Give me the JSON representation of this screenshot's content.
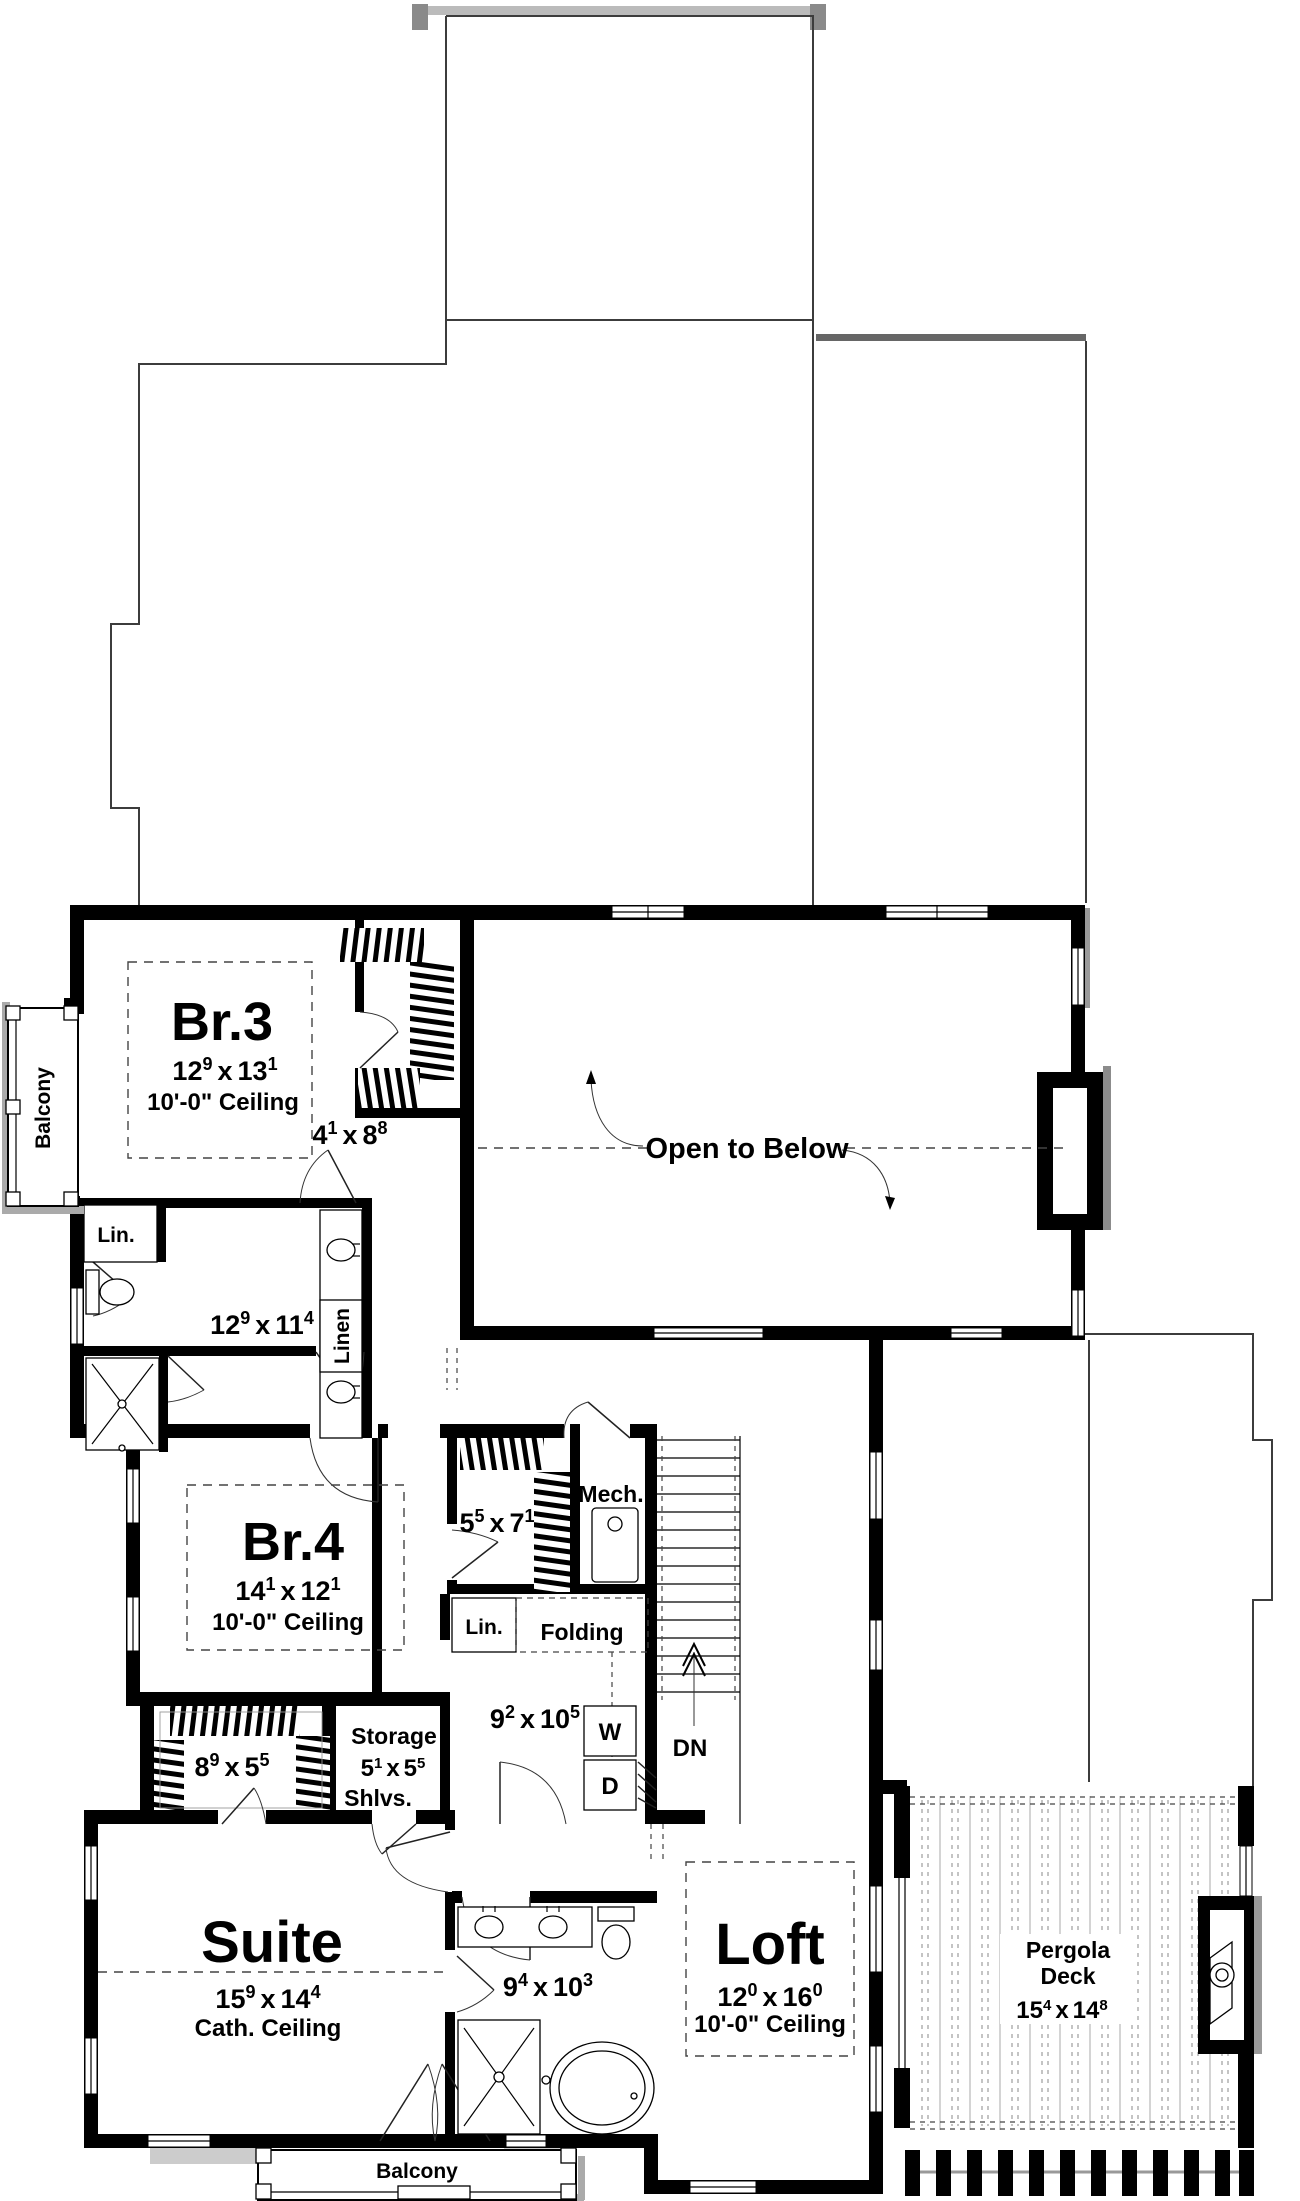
{
  "tokens": {
    "sep": "x"
  },
  "labels": {
    "open_to_below": "Open to Below",
    "balcony_left": "Balcony",
    "balcony_bottom": "Balcony",
    "down": "DN",
    "mech": "Mech.",
    "lin_bath": "Lin.",
    "linen": "Linen",
    "lin_laundry": "Lin.",
    "folding": "Folding",
    "washer": "W",
    "dryer": "D",
    "storage": "Storage",
    "shelves": "Shlvs."
  },
  "rooms": {
    "br3": {
      "name": "Br.3",
      "ceiling": "10'-0\" Ceiling",
      "dim": {
        "w": "12",
        "ws": "9",
        "l": "13",
        "ls": "1"
      }
    },
    "br3_closet": {
      "dim": {
        "w": "4",
        "ws": "1",
        "l": "8",
        "ls": "8"
      }
    },
    "jack_jill_bath": {
      "dim": {
        "w": "12",
        "ws": "9",
        "l": "11",
        "ls": "4"
      }
    },
    "br4": {
      "name": "Br.4",
      "ceiling": "10'-0\" Ceiling",
      "dim": {
        "w": "14",
        "ws": "1",
        "l": "12",
        "ls": "1"
      }
    },
    "br4_closet": {
      "dim": {
        "w": "5",
        "ws": "5",
        "l": "7",
        "ls": "1"
      }
    },
    "laundry": {
      "dim": {
        "w": "9",
        "ws": "2",
        "l": "10",
        "ls": "5"
      }
    },
    "storage": {
      "dim": {
        "w": "5",
        "ws": "1",
        "l": "5",
        "ls": "5"
      }
    },
    "suite_closet": {
      "dim": {
        "w": "8",
        "ws": "9",
        "l": "5",
        "ls": "5"
      }
    },
    "suite": {
      "name": "Suite",
      "ceiling": "Cath. Ceiling",
      "dim": {
        "w": "15",
        "ws": "9",
        "l": "14",
        "ls": "4"
      }
    },
    "master_bath": {
      "dim": {
        "w": "9",
        "ws": "4",
        "l": "10",
        "ls": "3"
      }
    },
    "loft": {
      "name": "Loft",
      "ceiling": "10'-0\" Ceiling",
      "dim": {
        "w": "12",
        "ws": "0",
        "l": "16",
        "ls": "0"
      }
    },
    "pergola": {
      "name1": "Pergola",
      "name2": "Deck",
      "dim": {
        "w": "15",
        "ws": "4",
        "l": "14",
        "ls": "8"
      }
    }
  }
}
